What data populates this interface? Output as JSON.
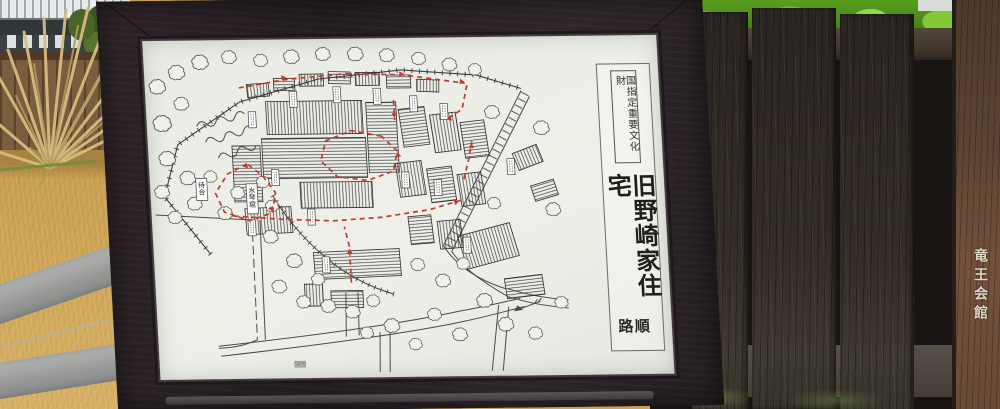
{
  "sign": {
    "designation_label": "国指定重要文化財",
    "title": "旧野崎家住宅",
    "route_label": "順路"
  },
  "site_map": {
    "labels": {
      "machiai": "待合",
      "suikinkutsu": "水琴窟"
    },
    "route_color": "#c23b2e",
    "north_arrow": true
  },
  "surroundings": {
    "hall_plaque_text": "竜王会館"
  },
  "colors": {
    "panel_white": "#e9ebe4",
    "frame_wood": "#272023",
    "dark_fence": "#2b2522",
    "plaque_brown": "#6a4a35",
    "grass": "#d0a758",
    "foliage_green": "#79b832",
    "map_ink": "#3c3c3c",
    "route_red": "#c23b2e"
  }
}
